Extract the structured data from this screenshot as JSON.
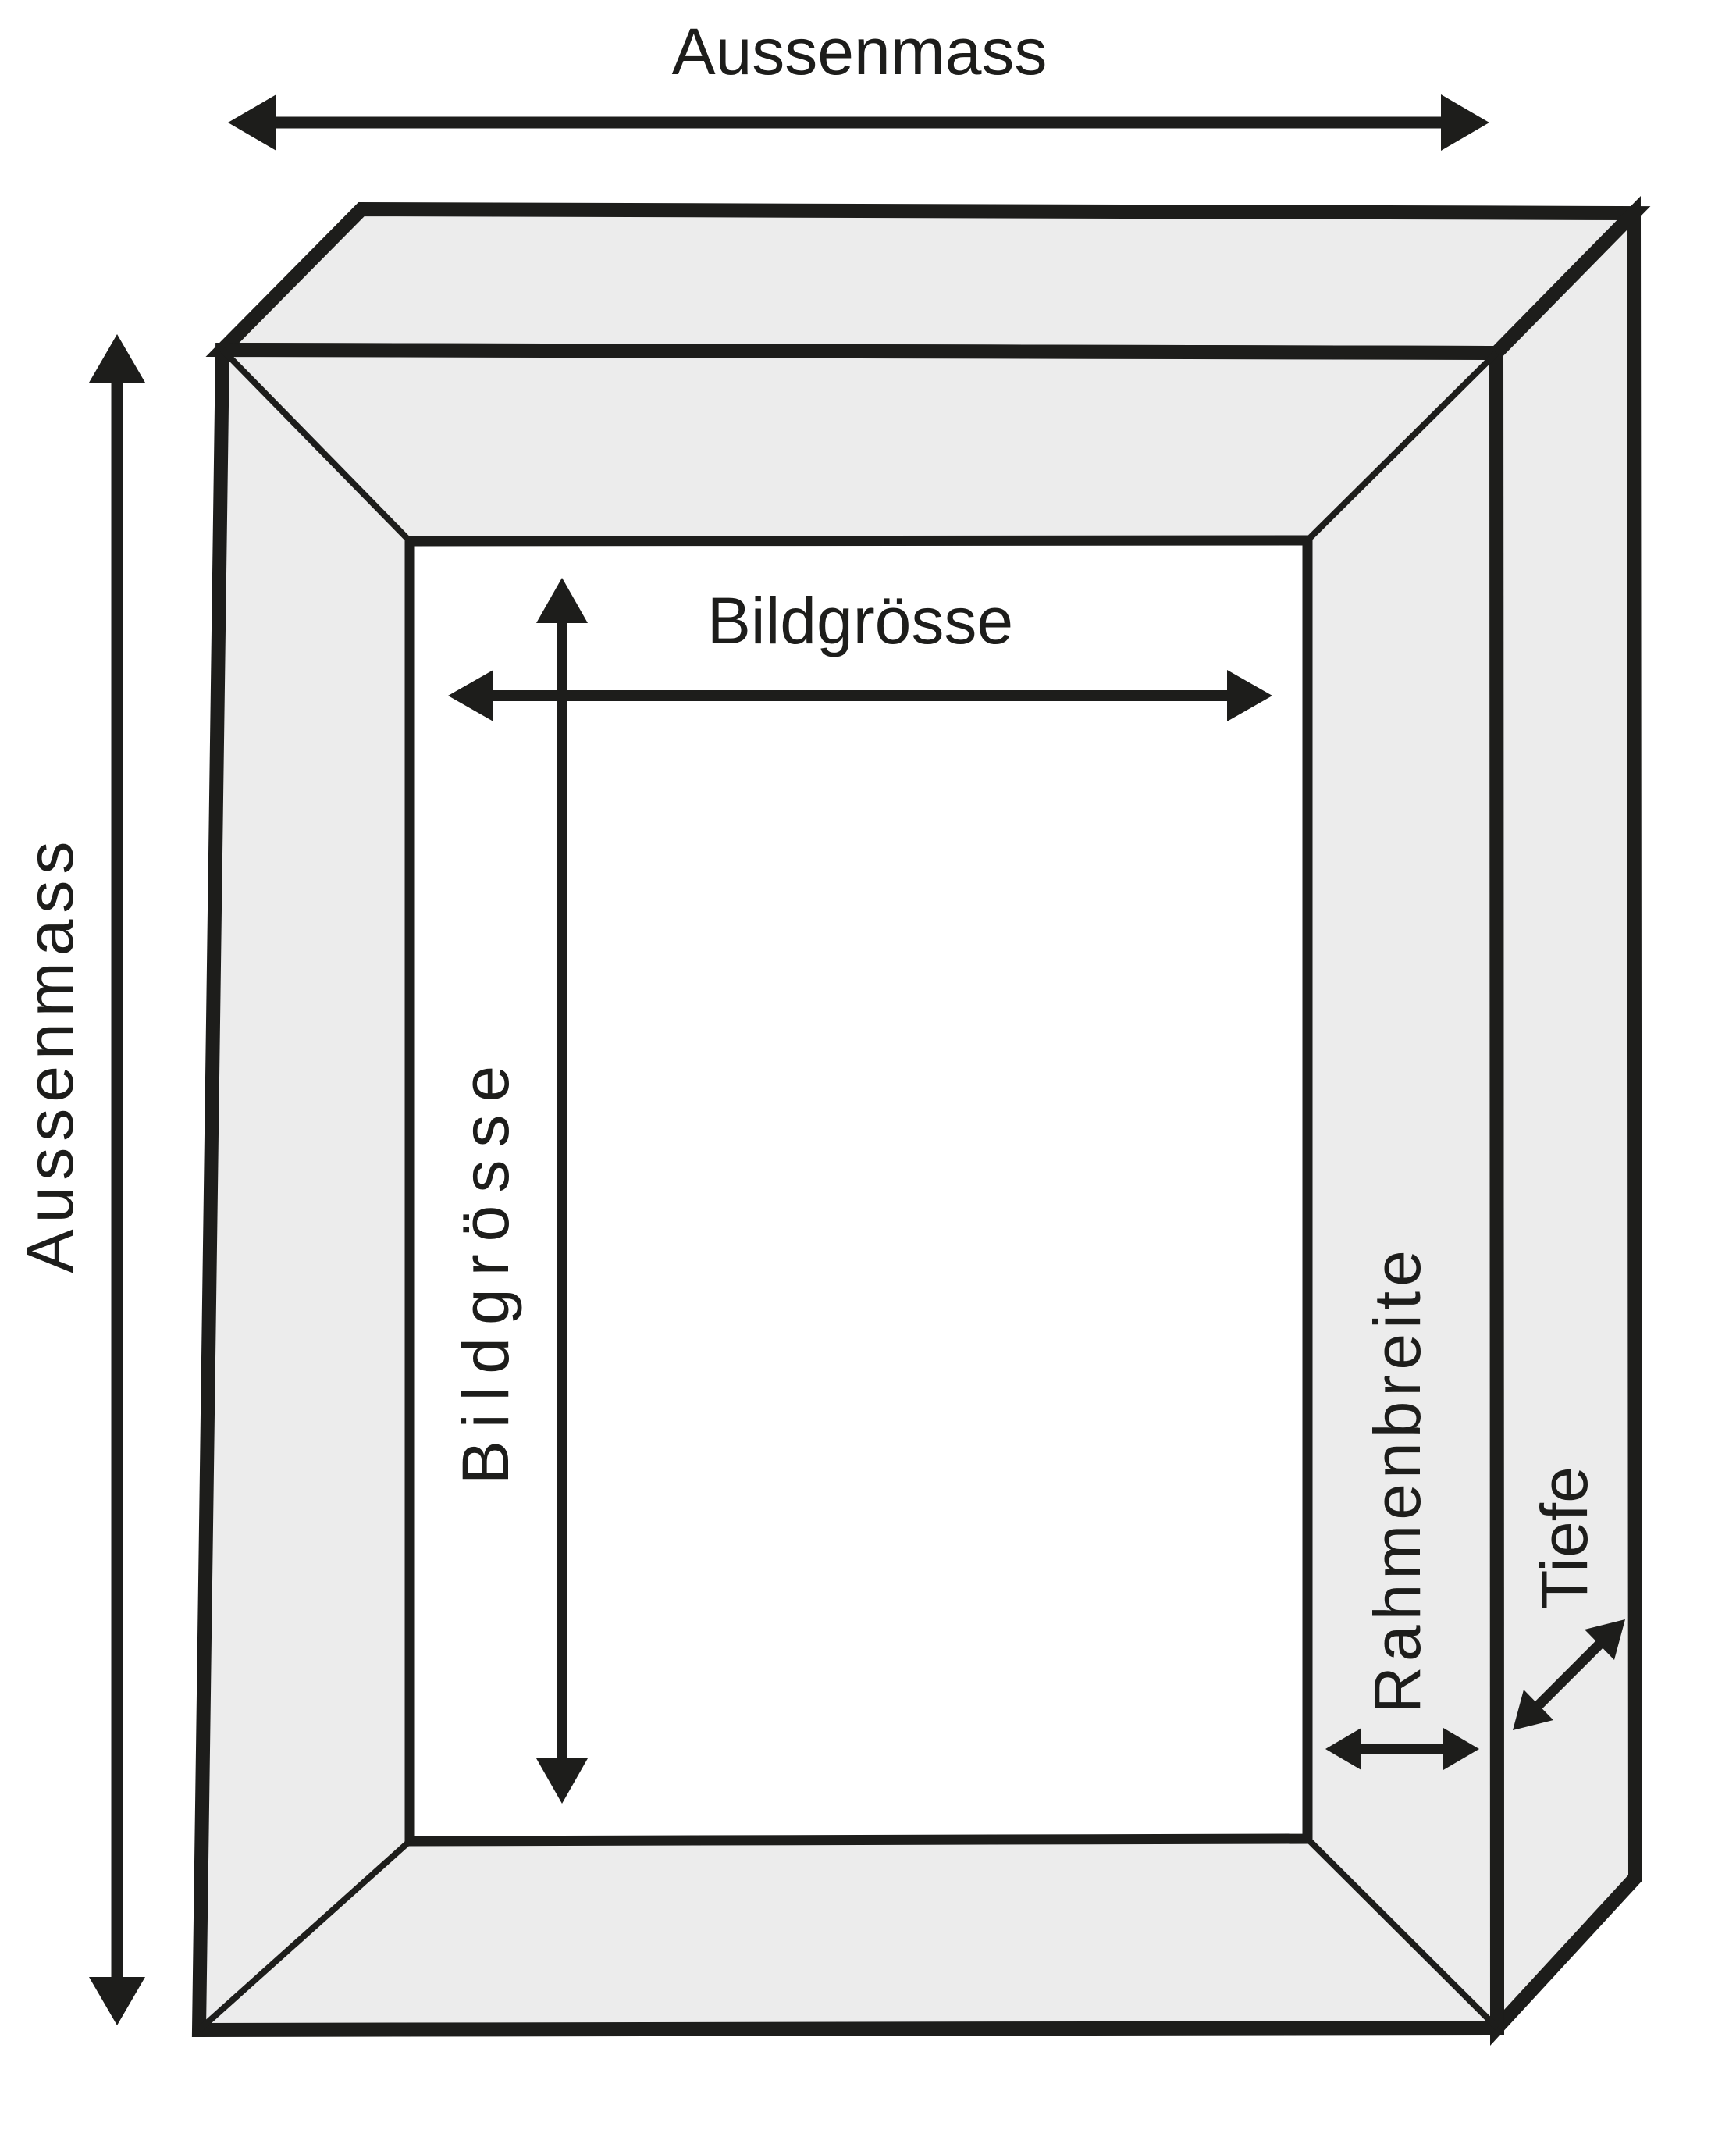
{
  "diagram": {
    "type": "picture-frame-dimension-diagram",
    "background_color": "#ffffff",
    "stroke_color": "#1d1d1b",
    "frame_face_color": "#ececec",
    "opening_color": "#ffffff",
    "labels": {
      "outer_width": "Aussenmass",
      "outer_height": "Aussenmass",
      "image_width": "Bildgrösse",
      "image_height": "Bildgrösse",
      "frame_border_width": "Rahmenbreite",
      "depth": "Tiefe"
    }
  }
}
